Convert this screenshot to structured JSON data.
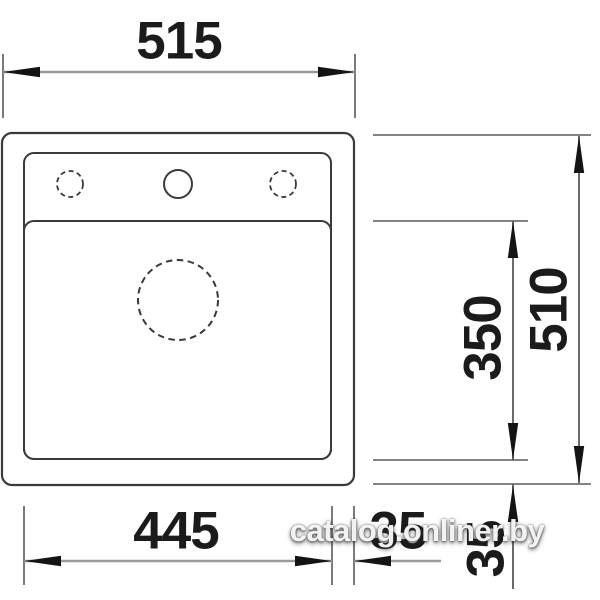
{
  "drawing": {
    "subject": "sink-technical-dimension-drawing-top-view",
    "features": {
      "outer_rim": "rounded rectangle outline",
      "inner_rim": "rounded rectangle outline",
      "deck_divider": "horizontal line separating tap deck from bowl",
      "tap_hole_left": "dashed circle",
      "tap_hole_center": "solid circle",
      "tap_hole_right": "dashed circle",
      "drain_hole": "dashed circle"
    },
    "colors": {
      "background": "#ffffff",
      "outline": "#3a3a3a",
      "dimension_line": "#9a9a9a",
      "extension_line": "#5a5a5a",
      "arrowhead": "#141414",
      "text": "#1b1b1b",
      "watermark_text": "#ffffff"
    }
  },
  "dimensions": {
    "overall_width": {
      "value": "515",
      "position": "top"
    },
    "overall_depth": {
      "value": "510",
      "position": "right"
    },
    "bowl_depth": {
      "value": "350",
      "position": "right-inner"
    },
    "bowl_width": {
      "value": "445",
      "position": "bottom"
    },
    "rim_offset_bottom": {
      "value": "35",
      "position": "bottom-right"
    },
    "rim_offset_right": {
      "value": "35",
      "position": "right-bottom"
    }
  },
  "watermark": {
    "text": "catalog.onliner.by"
  }
}
